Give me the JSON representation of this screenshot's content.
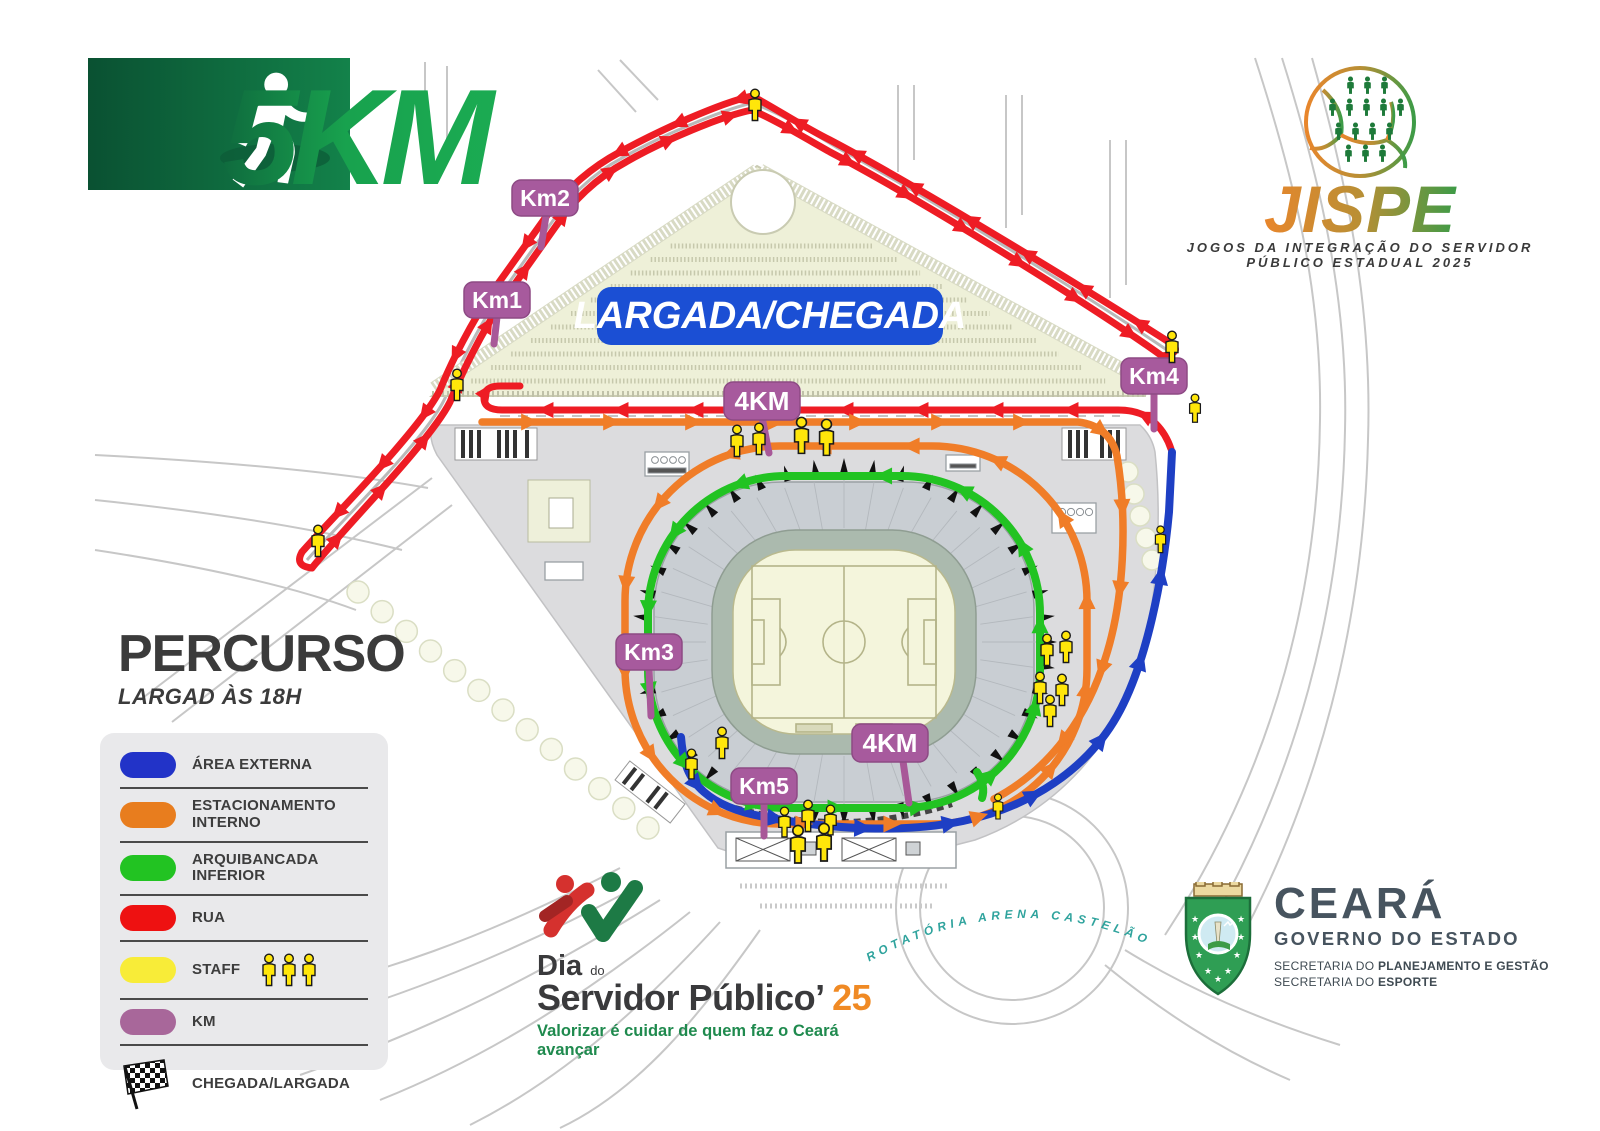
{
  "map": {
    "start_finish_label": "LARGADA/CHEGADA",
    "roundabout_label": "ROTATÓRIA ARENA CASTELÃO",
    "markers": {
      "km1": "Km1",
      "km2": "Km2",
      "km3": "Km3",
      "km4": "Km4",
      "km5": "Km5",
      "four_km_top": "4KM",
      "four_km_bottom": "4KM"
    }
  },
  "course": {
    "title": "PERCURSO",
    "subtitle": "LARGAD ÀS 18H",
    "legend": {
      "items": [
        {
          "label": "ÁREA EXTERNA",
          "color": "#2233c8"
        },
        {
          "label": "ESTACIONAMENTO INTERNO",
          "color": "#e87d1e"
        },
        {
          "label": "ARQUIBANCADA INFERIOR",
          "color": "#22c322"
        },
        {
          "label": "RUA",
          "color": "#ee1111"
        },
        {
          "label": "STAFF",
          "color": "#f8ec38",
          "icon": "staff-figures"
        },
        {
          "label": "KM",
          "color": "#a8679a"
        },
        {
          "label": "CHEGADA/LARGADA",
          "icon": "checkered-flag"
        }
      ]
    }
  },
  "logos": {
    "race": {
      "distance": "5KM"
    },
    "jispe": {
      "name": "JISPE",
      "subtitle_line1": "JOGOS DA INTEGRAÇÃO DO SERVIDOR",
      "subtitle_line2": "PÚBLICO ESTADUAL 2025"
    },
    "event": {
      "word1": "Dia",
      "word2": "do",
      "line2": "Servidor Público’",
      "year": "25",
      "tagline": "Valorizar é cuidar de quem faz o Ceará avançar"
    },
    "government": {
      "state": "CEARÁ",
      "line2": "GOVERNO DO ESTADO",
      "sec1_prefix": "SECRETARIA DO ",
      "sec1_bold": "PLANEJAMENTO E GESTÃO",
      "sec2_prefix": "SECRETARIA DO ",
      "sec2_bold": "ESPORTE"
    }
  },
  "colors": {
    "rua": "#ee1c24",
    "estacionamento_interno": "#f07d28",
    "arquibancada_inferior": "#22c322",
    "area_externa": "#1e3fc4",
    "staff": "#ffe60a",
    "km_marker": "#a75a9d",
    "start_finish_bg": "#1b4fd4",
    "logo_green": "#18a24e",
    "jispe_orange": "#e8862c",
    "jispe_green": "#3d9b47"
  }
}
